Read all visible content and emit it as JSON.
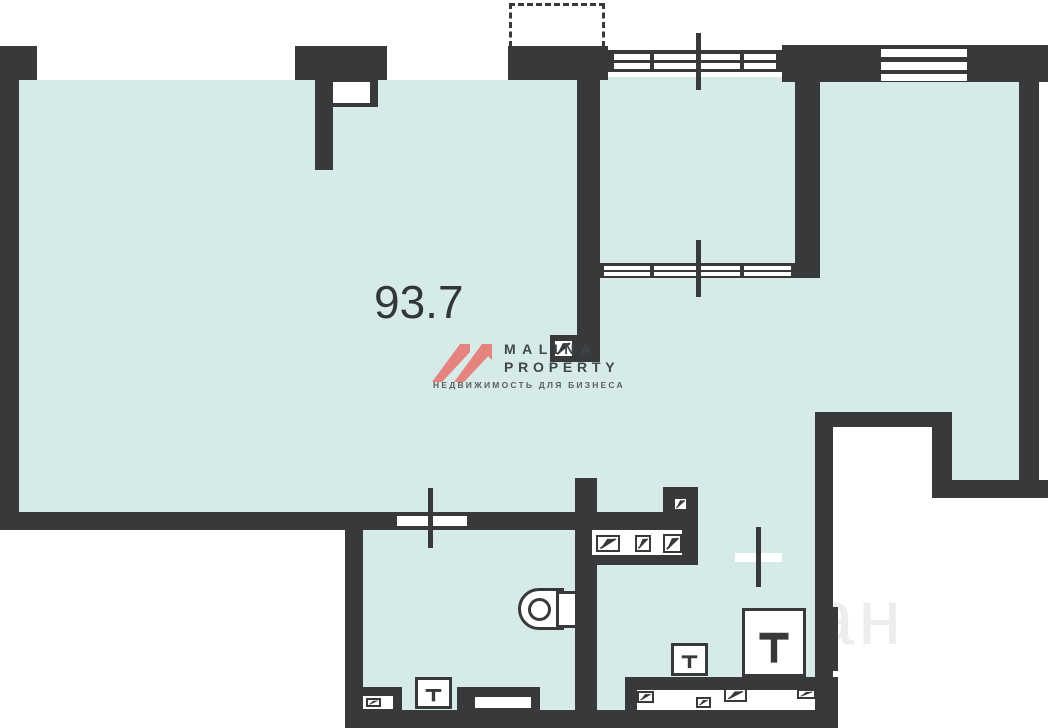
{
  "colors": {
    "wall": "#37393a",
    "floor": "#d6eae8",
    "background": "#ffffff",
    "logo_pink": "#e5837f",
    "logo_text": "#3f464a",
    "logo_tagline_color": "#59605f",
    "area_label_color": "#333638",
    "watermark_color": "#ededed"
  },
  "labels": {
    "area": "93.7"
  },
  "logo": {
    "line1": "MALINA",
    "line2": "PROPERTY",
    "tagline": "НЕДВИЖИМОСТЬ ДЛЯ БИЗНЕСА"
  },
  "watermark": {
    "text": "план"
  },
  "geometry": {
    "floors": [
      {
        "n": "main-hall-floor",
        "x": 19,
        "y": 80,
        "w": 558,
        "h": 432
      },
      {
        "n": "center-floor",
        "x": 577,
        "y": 77,
        "w": 243,
        "h": 435
      },
      {
        "n": "right-room-floor",
        "x": 820,
        "y": 82,
        "w": 199,
        "h": 330
      },
      {
        "n": "right-column-floor",
        "x": 950,
        "y": 412,
        "w": 69,
        "h": 70
      },
      {
        "n": "lower-rooms-floor",
        "x": 363,
        "y": 512,
        "w": 452,
        "h": 198
      }
    ],
    "walls": [
      {
        "n": "left-outer-wall",
        "x": 0,
        "y": 46,
        "w": 19,
        "h": 484
      },
      {
        "n": "top-wall-corner",
        "x": 0,
        "y": 46,
        "w": 37,
        "h": 34
      },
      {
        "n": "top-wall-pier",
        "x": 295,
        "y": 46,
        "w": 92,
        "h": 34
      },
      {
        "n": "top-wall-balcony-base",
        "x": 508,
        "y": 46,
        "w": 100,
        "h": 34
      },
      {
        "n": "top-right-wall",
        "x": 782,
        "y": 45,
        "w": 266,
        "h": 37
      },
      {
        "n": "right-outer-wall",
        "x": 1019,
        "y": 82,
        "w": 20,
        "h": 416
      },
      {
        "n": "notch-wall-horizontal",
        "x": 818,
        "y": 412,
        "w": 132,
        "h": 15
      },
      {
        "n": "notch-wall-vertical",
        "x": 932,
        "y": 412,
        "w": 20,
        "h": 86
      },
      {
        "n": "notch-wall-bottom",
        "x": 943,
        "y": 480,
        "w": 105,
        "h": 18
      },
      {
        "n": "hall-bottom-wall",
        "x": 0,
        "y": 512,
        "w": 698,
        "h": 18
      },
      {
        "n": "middle-room-left-wall",
        "x": 577,
        "y": 77,
        "w": 23,
        "h": 285
      },
      {
        "n": "duct-foot-box",
        "x": 550,
        "y": 335,
        "w": 27,
        "h": 27
      },
      {
        "n": "middle-room-right-wall",
        "x": 795,
        "y": 77,
        "w": 25,
        "h": 201
      },
      {
        "n": "wc-right-wall",
        "x": 575,
        "y": 478,
        "w": 22,
        "h": 232
      },
      {
        "n": "fixture-row-bottom-wall",
        "x": 588,
        "y": 555,
        "w": 94,
        "h": 10
      },
      {
        "n": "fixture-row-end-post",
        "x": 682,
        "y": 530,
        "w": 16,
        "h": 35
      },
      {
        "n": "lower-right-wall",
        "x": 815,
        "y": 412,
        "w": 18,
        "h": 298
      },
      {
        "n": "lower-right-wall-ledge",
        "x": 833,
        "y": 607,
        "w": 5,
        "h": 64
      },
      {
        "n": "lower-right-wall-corner",
        "x": 833,
        "y": 677,
        "w": 5,
        "h": 33
      },
      {
        "n": "bottom-outer-wall",
        "x": 345,
        "y": 710,
        "w": 493,
        "h": 18
      },
      {
        "n": "lower-left-outer-wall",
        "x": 345,
        "y": 530,
        "w": 18,
        "h": 180
      },
      {
        "n": "lower-right-room-south-wall",
        "x": 625,
        "y": 677,
        "w": 208,
        "h": 13
      },
      {
        "n": "locker-strip-stub",
        "x": 625,
        "y": 690,
        "w": 12,
        "h": 20
      },
      {
        "n": "wc-cabinet-box",
        "x": 357,
        "y": 687,
        "w": 45,
        "h": 23
      },
      {
        "n": "wc-counter-box",
        "x": 457,
        "y": 687,
        "w": 83,
        "h": 23
      },
      {
        "n": "pillar-head",
        "x": 315,
        "y": 80,
        "w": 63,
        "h": 27
      },
      {
        "n": "pillar-leg",
        "x": 315,
        "y": 80,
        "w": 18,
        "h": 90
      },
      {
        "n": "duct-box-doorway",
        "x": 663,
        "y": 487,
        "w": 35,
        "h": 28
      },
      {
        "n": "top-glazing-frame",
        "x": 608,
        "y": 50,
        "w": 174,
        "h": 22
      },
      {
        "n": "middle-room-glazing-frame",
        "x": 600,
        "y": 263,
        "w": 195,
        "h": 15
      }
    ],
    "openings": [
      {
        "n": "pillar-notch",
        "x": 333,
        "y": 82,
        "w": 37,
        "h": 21
      },
      {
        "n": "wc-window-opening",
        "x": 397,
        "y": 516,
        "w": 70,
        "h": 10
      },
      {
        "n": "lower-right-window-opening",
        "x": 735,
        "y": 553,
        "w": 47,
        "h": 9
      },
      {
        "n": "fixture-row-strip",
        "x": 592,
        "y": 530,
        "w": 90,
        "h": 25
      },
      {
        "n": "locker-strip",
        "x": 637,
        "y": 690,
        "w": 178,
        "h": 20
      },
      {
        "n": "wc-cabinet-inset",
        "x": 363,
        "y": 696,
        "w": 30,
        "h": 13
      },
      {
        "n": "wc-counter-inset",
        "x": 475,
        "y": 697,
        "w": 56,
        "h": 11
      },
      {
        "n": "top-glazing-slot-1",
        "x": 612,
        "y": 54,
        "w": 166,
        "h": 6
      },
      {
        "n": "top-glazing-slot-2",
        "x": 612,
        "y": 63,
        "w": 166,
        "h": 6
      },
      {
        "n": "middle-glazing-slot-1",
        "x": 604,
        "y": 266,
        "w": 187,
        "h": 4
      },
      {
        "n": "middle-glazing-slot-2",
        "x": 604,
        "y": 272,
        "w": 187,
        "h": 4
      },
      {
        "n": "window1-strip-1",
        "x": 37,
        "y": 50,
        "w": 258,
        "h": 7
      },
      {
        "n": "window1-strip-2",
        "x": 37,
        "y": 61,
        "w": 258,
        "h": 7
      },
      {
        "n": "window1-strip-3",
        "x": 37,
        "y": 72,
        "w": 258,
        "h": 7
      },
      {
        "n": "window2-strip-1",
        "x": 387,
        "y": 50,
        "w": 121,
        "h": 7
      },
      {
        "n": "window2-strip-2",
        "x": 387,
        "y": 61,
        "w": 121,
        "h": 7
      },
      {
        "n": "window2-strip-3",
        "x": 387,
        "y": 72,
        "w": 121,
        "h": 7
      },
      {
        "n": "window3-strip-1",
        "x": 881,
        "y": 49,
        "w": 86,
        "h": 8
      },
      {
        "n": "window3-strip-2",
        "x": 881,
        "y": 62,
        "w": 86,
        "h": 8
      },
      {
        "n": "window3-strip-3",
        "x": 881,
        "y": 74,
        "w": 86,
        "h": 7
      }
    ],
    "dividers": [
      {
        "n": "top-glazing-post-left",
        "x": 608,
        "y": 50,
        "w": 6,
        "h": 22
      },
      {
        "n": "top-glazing-mullion-1",
        "x": 650,
        "y": 50,
        "w": 4,
        "h": 22
      },
      {
        "n": "top-glazing-mullion-2",
        "x": 740,
        "y": 50,
        "w": 4,
        "h": 22
      },
      {
        "n": "top-glazing-post-right",
        "x": 776,
        "y": 50,
        "w": 6,
        "h": 22
      },
      {
        "n": "middle-glazing-mullion-1",
        "x": 650,
        "y": 263,
        "w": 4,
        "h": 15
      },
      {
        "n": "middle-glazing-mullion-2",
        "x": 740,
        "y": 263,
        "w": 4,
        "h": 15
      }
    ],
    "cross_marks": [
      {
        "n": "window-axis-top",
        "x": 696,
        "y": 33,
        "w": 5,
        "h": 57
      },
      {
        "n": "window-axis-middle",
        "x": 696,
        "y": 240,
        "w": 5,
        "h": 57
      },
      {
        "n": "window-axis-wc",
        "x": 428,
        "y": 488,
        "w": 5,
        "h": 60
      },
      {
        "n": "window-axis-lower-right",
        "x": 756,
        "y": 527,
        "w": 5,
        "h": 60
      }
    ],
    "flap_fixtures": [
      {
        "n": "duct-hatch-wall-end",
        "x": 553,
        "y": 339,
        "w": 21,
        "h": 19
      },
      {
        "n": "duct-hatch-doorway",
        "x": 673,
        "y": 497,
        "w": 15,
        "h": 14
      },
      {
        "n": "cabinet-hatch-1",
        "x": 596,
        "y": 535,
        "w": 24,
        "h": 17
      },
      {
        "n": "cabinet-hatch-2",
        "x": 635,
        "y": 535,
        "w": 16,
        "h": 17
      },
      {
        "n": "cabinet-hatch-3",
        "x": 663,
        "y": 534,
        "w": 19,
        "h": 19
      },
      {
        "n": "locker-hatch-1",
        "x": 637,
        "y": 691,
        "w": 17,
        "h": 12
      },
      {
        "n": "locker-hatch-2",
        "x": 696,
        "y": 697,
        "w": 15,
        "h": 11
      },
      {
        "n": "locker-hatch-3",
        "x": 724,
        "y": 688,
        "w": 23,
        "h": 14
      },
      {
        "n": "locker-hatch-4",
        "x": 797,
        "y": 689,
        "w": 19,
        "h": 10
      },
      {
        "n": "wc-cabinet-hatch",
        "x": 366,
        "y": 698,
        "w": 15,
        "h": 9
      }
    ],
    "tee_fixtures": [
      {
        "n": "sink-wc",
        "x": 415,
        "y": 677,
        "w": 37,
        "h": 32
      },
      {
        "n": "sink-lower-right-small",
        "x": 671,
        "y": 643,
        "w": 37,
        "h": 33
      },
      {
        "n": "sink-lower-right-large",
        "x": 742,
        "y": 608,
        "w": 64,
        "h": 69
      }
    ],
    "toilet": {
      "capsule": {
        "x": 518,
        "y": 588,
        "w": 46,
        "h": 42
      },
      "circle": {
        "x": 528,
        "y": 598,
        "w": 23,
        "h": 23
      },
      "cistern": {
        "x": 556,
        "y": 591,
        "w": 22,
        "h": 37
      }
    },
    "balcony_dashed": {
      "x": 509,
      "y": 3,
      "w": 96,
      "h": 44
    },
    "watermark_pos": {
      "x": 715,
      "y": 572
    }
  }
}
